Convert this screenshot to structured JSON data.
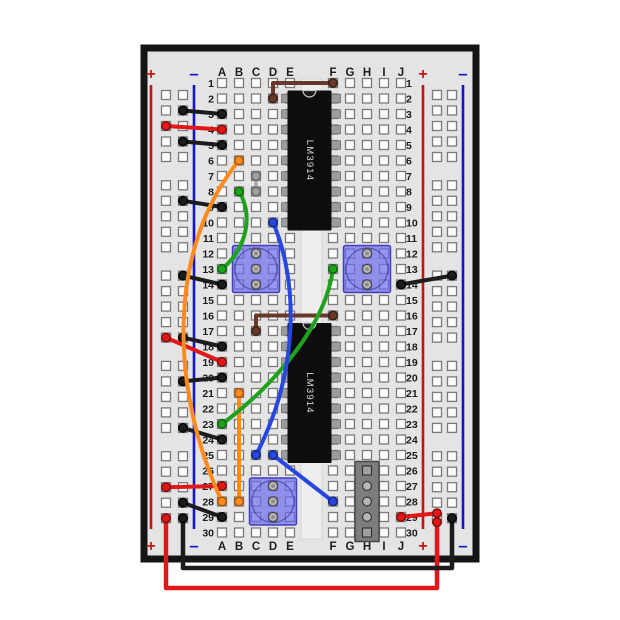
{
  "board": {
    "letters_left": [
      "A",
      "B",
      "C",
      "D",
      "E"
    ],
    "letters_right": [
      "F",
      "G",
      "H",
      "I",
      "J"
    ],
    "row_count": 30,
    "plus_sign": "+",
    "minus_sign": "–"
  },
  "colors": {
    "board_fill": "#e4e4e4",
    "board_border": "#141414",
    "channel_fill": "#eeeeee",
    "hole_fill": "#fcfcfc",
    "hole_border": "#7a7a7a",
    "rail_positive_line": "#cc1111",
    "rail_negative_line": "#1515cc",
    "label_color": "#1c1c1c",
    "ic_body": "#0d0d0d",
    "ic_label_color": "#d8d8d8",
    "ic_pin": "#9c9c9c",
    "trimpot_fill": "rgba(108,108,240,0.70)",
    "trimpot_border": "#4040bb",
    "trimpot_pin": "#b6b6b6",
    "header_fill": "#7d7d7d",
    "header_border": "#4a4a4a",
    "wire_black": "#1c1c1c",
    "wire_red": "#e01818",
    "wire_orange": "#ff8a1e",
    "wire_green": "#1ea21e",
    "wire_blue": "#2747e0",
    "wire_brown": "#68392b",
    "wire_gray": "#a0a0a0"
  },
  "components": {
    "ics": [
      {
        "id": "ic-lm3914-top",
        "label": "LM3914",
        "row_start": 2,
        "row_end": 10
      },
      {
        "id": "ic-lm3914-bottom",
        "label": "LM3914",
        "row_start": 17,
        "row_end": 25
      }
    ],
    "trimpots": [
      {
        "id": "trimpot-left",
        "pin_col": "C",
        "rows": [
          12,
          13,
          14
        ]
      },
      {
        "id": "trimpot-right",
        "pin_col": "H",
        "rows": [
          12,
          13,
          14
        ]
      },
      {
        "id": "trimpot-bottom",
        "pin_col": "D",
        "rows": [
          27,
          28,
          29
        ]
      }
    ],
    "header": {
      "id": "header-5pin",
      "pin_col": "H",
      "rows": [
        26,
        27,
        28,
        29,
        30
      ]
    }
  },
  "wires": [
    {
      "id": "wire-black-lrail-a3",
      "color": "black",
      "from": "L-:1",
      "to": "A3",
      "shape": "line"
    },
    {
      "id": "wire-red-lrail-a4",
      "color": "red",
      "from": "L+:2",
      "to": "A4",
      "shape": "line"
    },
    {
      "id": "wire-black-lrail-a5",
      "color": "black",
      "from": "L-:3",
      "to": "A5",
      "shape": "line"
    },
    {
      "id": "wire-black-lrail-a9",
      "color": "black",
      "from": "L-:6",
      "to": "A9",
      "shape": "line"
    },
    {
      "id": "wire-black-lrail-a14",
      "color": "black",
      "from": "L-:10",
      "to": "A14",
      "shape": "line"
    },
    {
      "id": "wire-black-lrail-a18",
      "color": "black",
      "from": "L-:14",
      "to": "A18",
      "shape": "line"
    },
    {
      "id": "wire-red-lrail-a19",
      "color": "red",
      "from": "L+:14",
      "to": "A19",
      "shape": "line"
    },
    {
      "id": "wire-black-lrail-a20",
      "color": "black",
      "from": "L-:16",
      "to": "A20",
      "shape": "line"
    },
    {
      "id": "wire-black-lrail-a24",
      "color": "black",
      "from": "L-:19",
      "to": "A24",
      "shape": "line"
    },
    {
      "id": "wire-red-lrail-a27",
      "color": "red",
      "from": "L+:22",
      "to": "A27",
      "shape": "line"
    },
    {
      "id": "wire-black-lrail-a29",
      "color": "black",
      "from": "L-:23",
      "to": "A29",
      "shape": "line"
    },
    {
      "id": "wire-black-j14-rrail",
      "color": "black",
      "from": "J14",
      "to": "R-:10",
      "shape": "line"
    },
    {
      "id": "wire-red-j29-rrail",
      "color": "red",
      "from": "J29",
      "to": "R+:24",
      "shape": "line",
      "to_offset": [
        0,
        -5
      ]
    },
    {
      "id": "wire-red-external",
      "color": "red",
      "from": "L+:24",
      "to": "R+:24",
      "shape": "poly",
      "via": [
        [
          166,
          588
        ],
        [
          437,
          588
        ]
      ],
      "to_offset": [
        0,
        4
      ],
      "width": 4.5
    },
    {
      "id": "wire-black-external",
      "color": "black",
      "from": "L-:24",
      "to": "R-:24",
      "shape": "poly",
      "via": [
        [
          183,
          568
        ],
        [
          452,
          568
        ]
      ],
      "width": 4.5
    },
    {
      "id": "wire-brown-d2-f1",
      "color": "brown",
      "from": "D2",
      "to": "F1",
      "shape": "elbow"
    },
    {
      "id": "wire-brown-c17-f16",
      "color": "brown",
      "from": "C17",
      "to": "F16",
      "shape": "elbow"
    },
    {
      "id": "wire-gray-c7-c8",
      "color": "gray",
      "from": "C7",
      "to": "C8",
      "shape": "line",
      "width": 3
    },
    {
      "id": "wire-orange-b6-a28",
      "color": "orange",
      "from": "B6",
      "to": "A28",
      "shape": "curve",
      "ctrl": [
        [
          166,
          250
        ],
        [
          170,
          390
        ]
      ]
    },
    {
      "id": "wire-orange-b21-b28",
      "color": "orange",
      "from": "B21",
      "to": "B28",
      "shape": "line"
    },
    {
      "id": "wire-green-b8-a13",
      "color": "green",
      "from": "B8",
      "to": "A13",
      "shape": "curve",
      "ctrl": [
        [
          253,
          214
        ],
        [
          248,
          247
        ]
      ]
    },
    {
      "id": "wire-green-f13-a23",
      "color": "green",
      "from": "F13",
      "to": "A23",
      "shape": "curve",
      "ctrl": [
        [
          326,
          324
        ],
        [
          276,
          384
        ]
      ]
    },
    {
      "id": "wire-blue-d10-c25",
      "color": "blue",
      "from": "D10",
      "to": "C25",
      "shape": "curve",
      "ctrl": [
        [
          298,
          280
        ],
        [
          300,
          370
        ]
      ]
    },
    {
      "id": "wire-blue-d25-f28",
      "color": "blue",
      "from": "D25",
      "to": "F28",
      "shape": "line"
    }
  ]
}
